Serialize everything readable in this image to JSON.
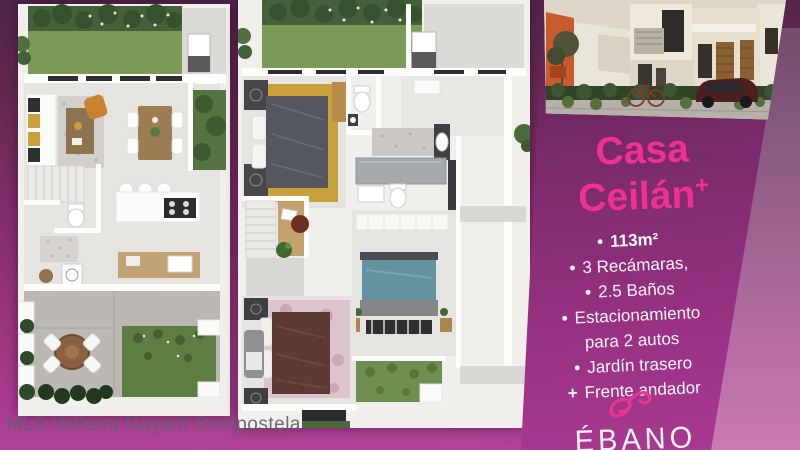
{
  "card": {
    "title_line1": "Casa",
    "title_line2": "Ceilán",
    "title_superscript": "+",
    "features": [
      {
        "marker": "•",
        "text": "113m²"
      },
      {
        "marker": "•",
        "text": "3 Recámaras,"
      },
      {
        "marker": "•",
        "text": "2.5 Baños"
      },
      {
        "marker": "•",
        "text": "Estacionamiento",
        "text2": "para 2 autos"
      },
      {
        "marker": "•",
        "text": "Jardín trasero"
      },
      {
        "marker": "+",
        "text": "Frente andador"
      }
    ],
    "logo": {
      "name": "ÉBANO",
      "tagline": "residencial"
    }
  },
  "watermark": "MLS Vallarta Nayarit Compostela",
  "floor_plans": {
    "left_plan": "planta baja - sala, comedor, cocina, medio baño, jardín trasero, terraza",
    "right_plan": "planta alta - 3 recámaras, 2 baños, escaleras, estudio"
  },
  "colors": {
    "brand_pink": "#ef3196",
    "card_purple": "#842c74",
    "background_magenta": "#a93b8f",
    "lawn_green": "#7a9a55",
    "watermark_gray": "#63606c"
  }
}
